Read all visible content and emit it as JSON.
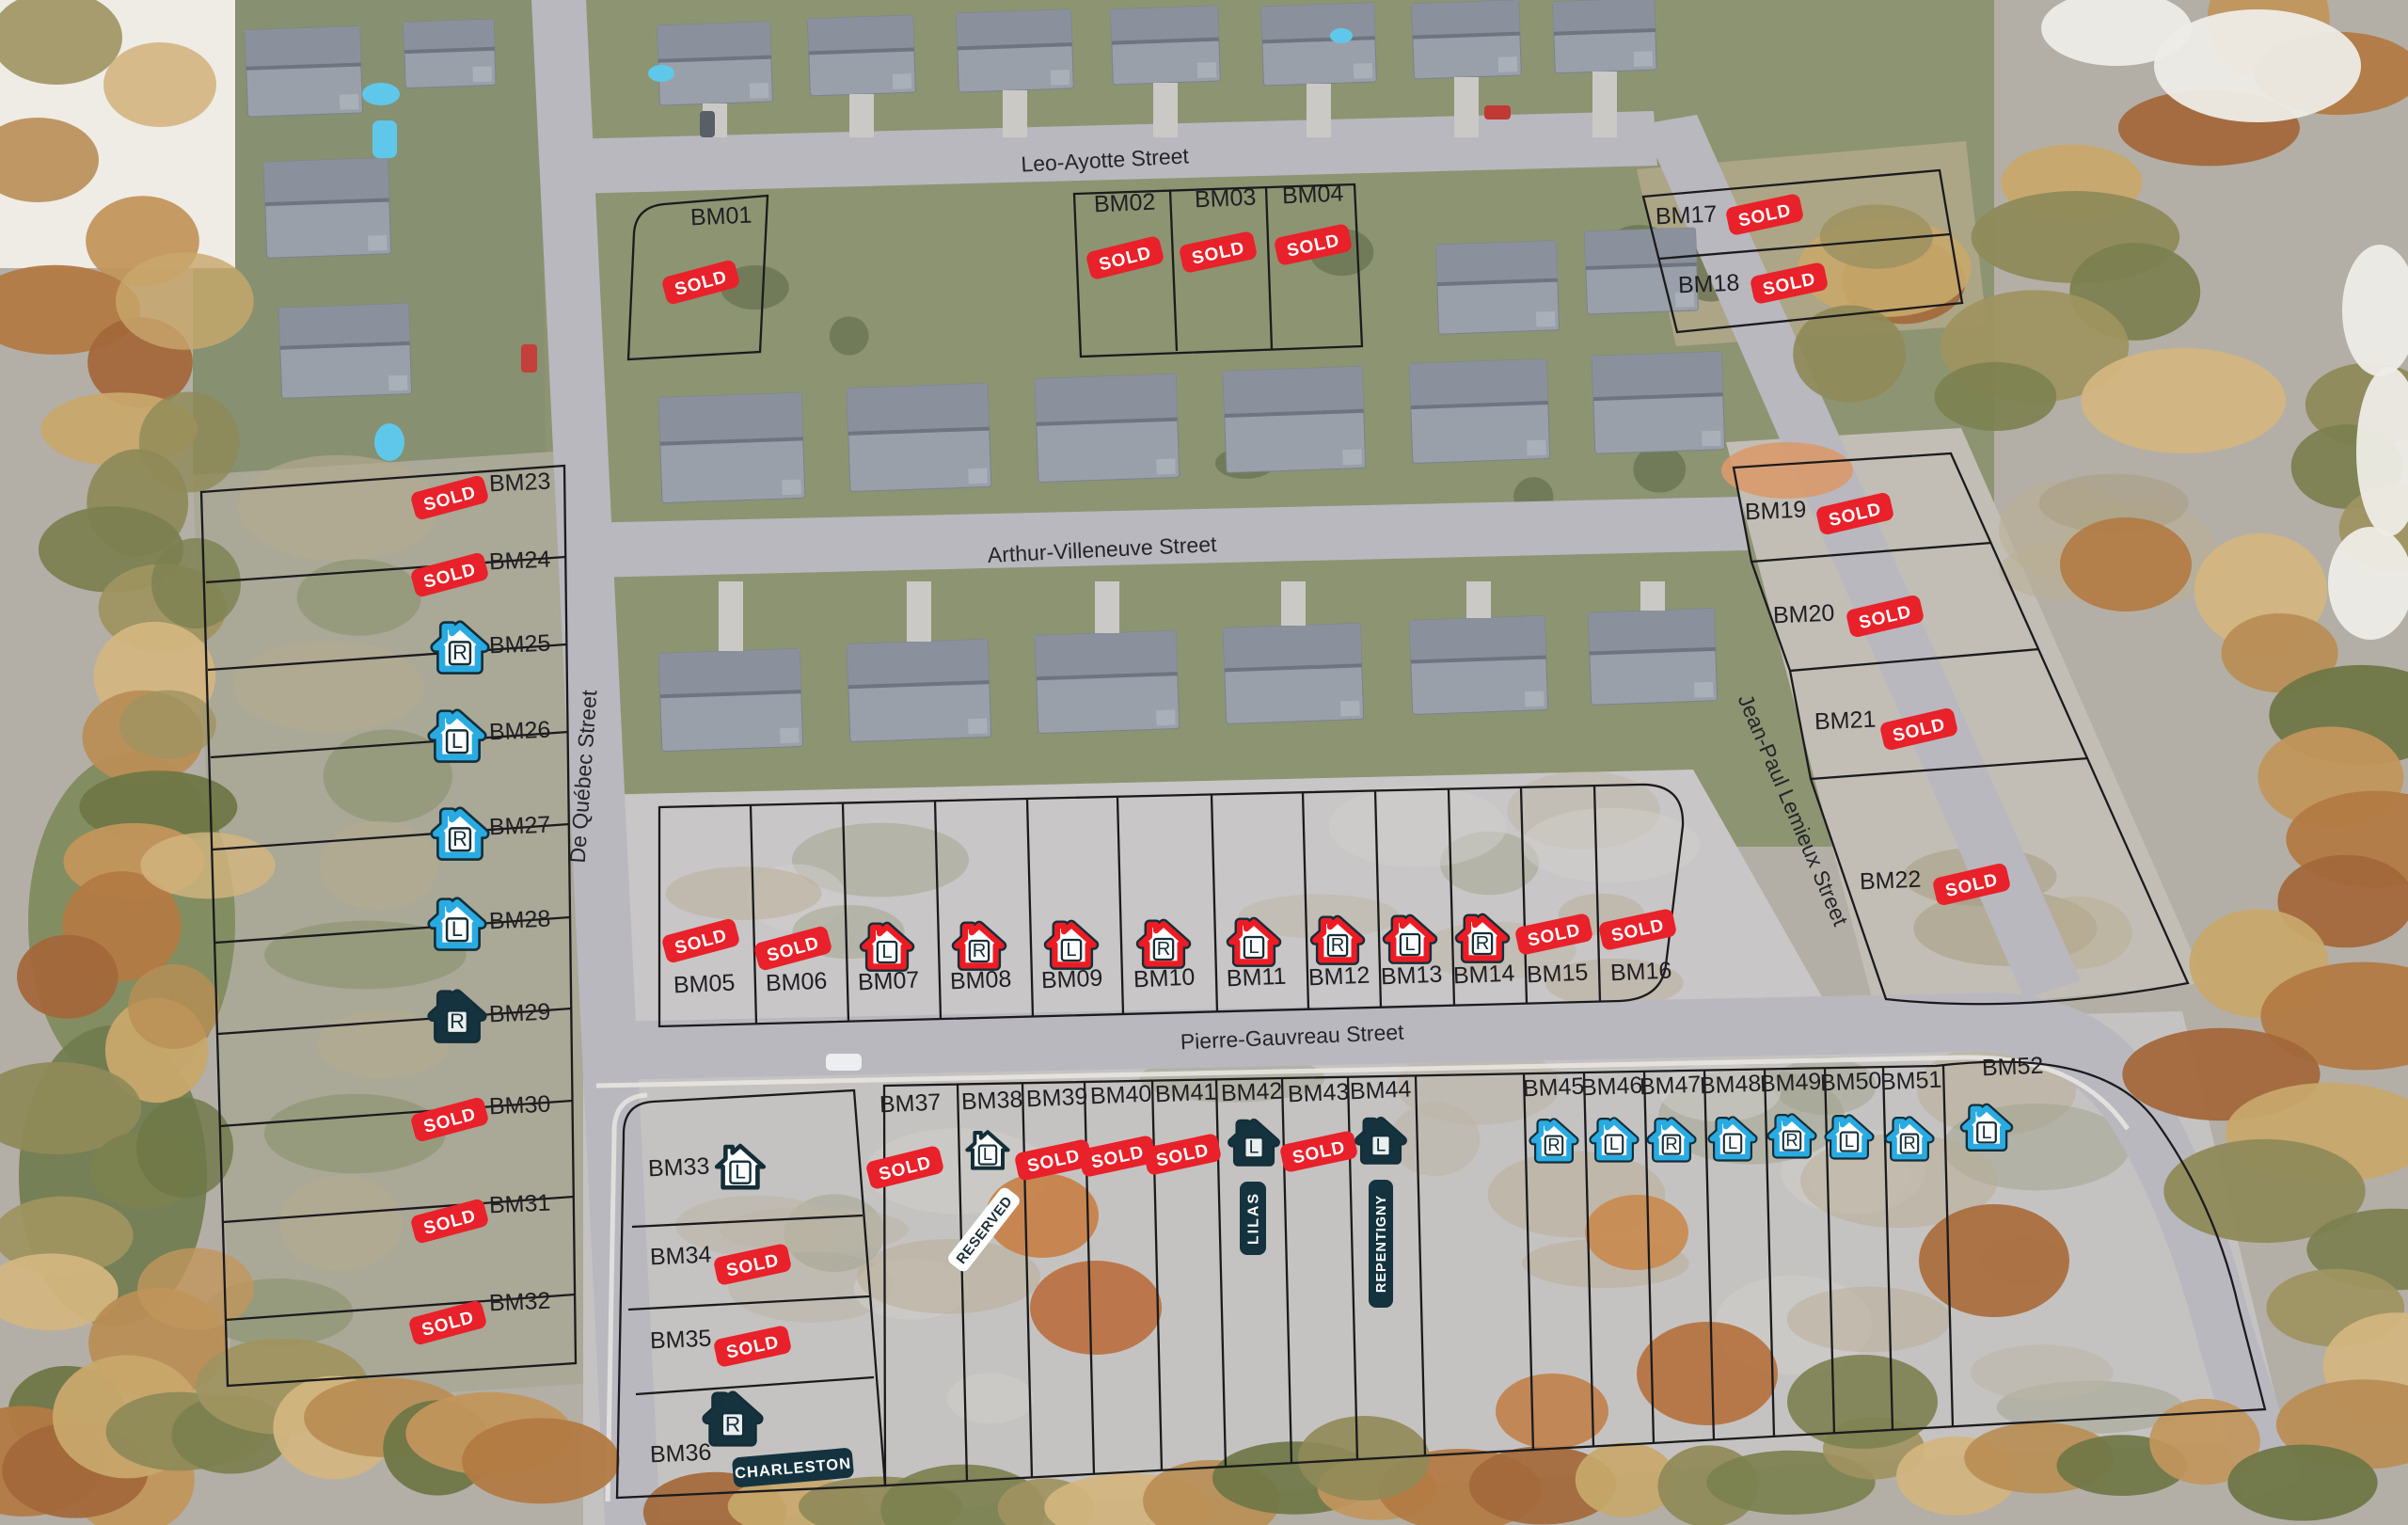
{
  "streets": {
    "leo_ayotte": {
      "label": "Leo-Ayotte Street"
    },
    "arthur_villeneuve": {
      "label": "Arthur-Villeneuve Street"
    },
    "pierre_gauvreau": {
      "label": "Pierre-Gauvreau Street"
    },
    "de_quebec": {
      "label": "De Québec Street"
    },
    "jean_paul_lemieux": {
      "label": "Jean-Paul Lemieux Street"
    }
  },
  "badges": {
    "sold": "SOLD",
    "reserved": "RESERVED"
  },
  "model_homes": {
    "charleston": "CHARLESTON",
    "lilas": "LILAS",
    "repentigny": "REPENTIGNY"
  },
  "colors": {
    "sold_badge": "#E8212A",
    "red_house": "#ED1C24",
    "blue_house": "#29ABE2",
    "dark_house": "#15333E",
    "white_house": "#FFFFFF",
    "icon_outline": "#142E38",
    "name_badge": "#14333F"
  },
  "lots": [
    {
      "id": "BM01",
      "status": "sold"
    },
    {
      "id": "BM02",
      "status": "sold"
    },
    {
      "id": "BM03",
      "status": "sold"
    },
    {
      "id": "BM04",
      "status": "sold"
    },
    {
      "id": "BM05",
      "status": "sold"
    },
    {
      "id": "BM06",
      "status": "sold"
    },
    {
      "id": "BM07",
      "status": "model",
      "house": "red",
      "letter": "L"
    },
    {
      "id": "BM08",
      "status": "model",
      "house": "red",
      "letter": "R"
    },
    {
      "id": "BM09",
      "status": "model",
      "house": "red",
      "letter": "L"
    },
    {
      "id": "BM10",
      "status": "model",
      "house": "red",
      "letter": "R"
    },
    {
      "id": "BM11",
      "status": "model",
      "house": "red",
      "letter": "L"
    },
    {
      "id": "BM12",
      "status": "model",
      "house": "red",
      "letter": "R"
    },
    {
      "id": "BM13",
      "status": "model",
      "house": "red",
      "letter": "L"
    },
    {
      "id": "BM14",
      "status": "model",
      "house": "red",
      "letter": "R"
    },
    {
      "id": "BM15",
      "status": "sold"
    },
    {
      "id": "BM16",
      "status": "sold"
    },
    {
      "id": "BM17",
      "status": "sold"
    },
    {
      "id": "BM18",
      "status": "sold"
    },
    {
      "id": "BM19",
      "status": "sold"
    },
    {
      "id": "BM20",
      "status": "sold"
    },
    {
      "id": "BM21",
      "status": "sold"
    },
    {
      "id": "BM22",
      "status": "sold"
    },
    {
      "id": "BM23",
      "status": "sold"
    },
    {
      "id": "BM24",
      "status": "sold"
    },
    {
      "id": "BM25",
      "status": "model",
      "house": "blue",
      "letter": "R"
    },
    {
      "id": "BM26",
      "status": "model",
      "house": "blue",
      "letter": "L"
    },
    {
      "id": "BM27",
      "status": "model",
      "house": "blue",
      "letter": "R"
    },
    {
      "id": "BM28",
      "status": "model",
      "house": "blue",
      "letter": "L"
    },
    {
      "id": "BM29",
      "status": "model",
      "house": "dark",
      "letter": "R"
    },
    {
      "id": "BM30",
      "status": "sold"
    },
    {
      "id": "BM31",
      "status": "sold"
    },
    {
      "id": "BM32",
      "status": "sold"
    },
    {
      "id": "BM33",
      "status": "model",
      "house": "white",
      "letter": "L"
    },
    {
      "id": "BM34",
      "status": "sold"
    },
    {
      "id": "BM35",
      "status": "sold"
    },
    {
      "id": "BM36",
      "status": "model",
      "house": "dark",
      "letter": "R",
      "model_name": "CHARLESTON"
    },
    {
      "id": "BM37",
      "status": "sold"
    },
    {
      "id": "BM38",
      "status": "model",
      "house": "white",
      "letter": "L",
      "note": "RESERVED"
    },
    {
      "id": "BM39",
      "status": "sold"
    },
    {
      "id": "BM40",
      "status": "sold"
    },
    {
      "id": "BM41",
      "status": "sold"
    },
    {
      "id": "BM42",
      "status": "model",
      "house": "dark",
      "letter": "L",
      "model_name": "LILAS"
    },
    {
      "id": "BM43",
      "status": "sold"
    },
    {
      "id": "BM44",
      "status": "model",
      "house": "dark",
      "letter": "L",
      "model_name": "REPENTIGNY"
    },
    {
      "id": "BM45",
      "status": "model",
      "house": "blue",
      "letter": "R"
    },
    {
      "id": "BM46",
      "status": "model",
      "house": "blue",
      "letter": "L"
    },
    {
      "id": "BM47",
      "status": "model",
      "house": "blue",
      "letter": "R"
    },
    {
      "id": "BM48",
      "status": "model",
      "house": "blue",
      "letter": "L"
    },
    {
      "id": "BM49",
      "status": "model",
      "house": "blue",
      "letter": "R"
    },
    {
      "id": "BM50",
      "status": "model",
      "house": "blue",
      "letter": "L"
    },
    {
      "id": "BM51",
      "status": "model",
      "house": "blue",
      "letter": "R"
    },
    {
      "id": "BM52",
      "status": "model",
      "house": "blue",
      "letter": "L"
    }
  ]
}
